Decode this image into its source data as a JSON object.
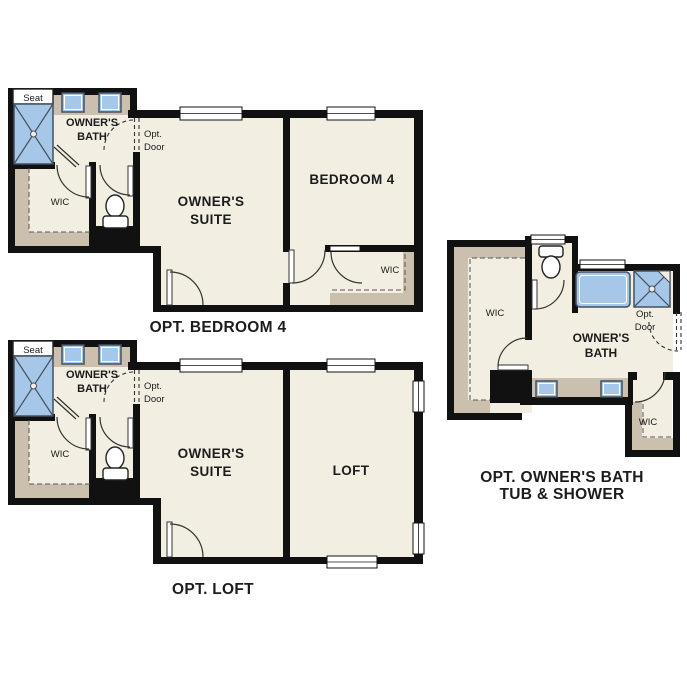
{
  "colors": {
    "wall": "#111111",
    "floor": "#f3eee2",
    "tan": "#cbc0ad",
    "fixture": "#a7c7e8",
    "text": "#1c1c1c",
    "bg": "#ffffff"
  },
  "plan_bedroom4": {
    "caption": "OPT. BEDROOM 4",
    "seat": "Seat",
    "bath_line1": "OWNER'S",
    "bath_line2": "BATH",
    "wic": "WIC",
    "opt_door_line1": "Opt.",
    "opt_door_line2": "Door",
    "suite_line1": "OWNER'S",
    "suite_line2": "SUITE",
    "bedroom": "BEDROOM 4",
    "bedroom_wic": "WIC"
  },
  "plan_loft": {
    "caption": "OPT. LOFT",
    "seat": "Seat",
    "bath_line1": "OWNER'S",
    "bath_line2": "BATH",
    "wic": "WIC",
    "opt_door_line1": "Opt.",
    "opt_door_line2": "Door",
    "suite_line1": "OWNER'S",
    "suite_line2": "SUITE",
    "loft": "LOFT"
  },
  "plan_owners_bath": {
    "caption_line1": "OPT. OWNER'S BATH",
    "caption_line2": "TUB & SHOWER",
    "wic_left": "WIC",
    "bath_line1": "OWNER'S",
    "bath_line2": "BATH",
    "opt_door_line1": "Opt.",
    "opt_door_line2": "Door",
    "wic_right": "WIC"
  }
}
